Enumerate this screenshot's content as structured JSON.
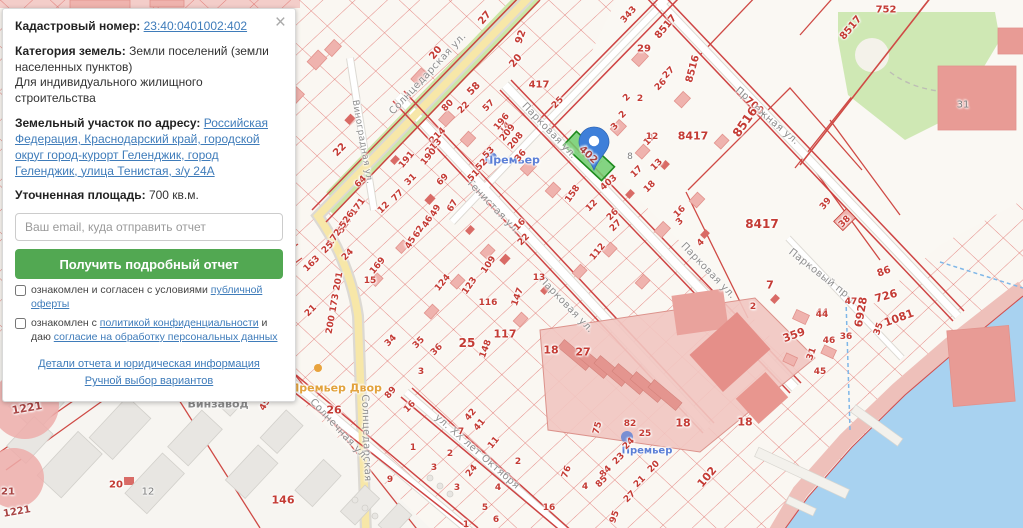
{
  "panel": {
    "close_label": "×",
    "cadastral_label": "Кадастровый номер:",
    "cadastral_number": "23:40:0401002:402",
    "category_label": "Категория земель:",
    "category_value": "Земли поселений (земли населенных пунктов)",
    "category_extra": "Для индивидуального жилищного строительства",
    "address_label": "Земельный участок по адресу:",
    "address_value": "Российская Федерация, Краснодарский край, городской округ город-курорт Геленджик, город Геленджик, улица Тенистая, з/у 24А",
    "area_label": "Уточненная площадь:",
    "area_value": "700 кв.м.",
    "email_placeholder": "Ваш email, куда отправить отчет",
    "submit_label": "Получить подробный отчет",
    "checkbox1_prefix": "ознакомлен и согласен с условиями ",
    "checkbox1_link": "публичной оферты",
    "checkbox2_prefix": "ознакомлен с ",
    "checkbox2_link": "политикой конфиденциальности",
    "checkbox2_middle": " и даю ",
    "checkbox2_link2": "согласие на обработку персональных данных",
    "link_details": "Детали отчета и юридическая информация",
    "link_manual": "Ручной выбор вариантов"
  },
  "map": {
    "highlighted_parcel": "402",
    "colors": {
      "water": "#a8d2f0",
      "park": "#cfe8b4",
      "parcel_lines": "#dd5f5a",
      "highlight_fill": "#6fce6f",
      "marker": "#3e7fd9",
      "road_yellow": "#f7e7a8"
    },
    "labels": [
      [
        "Солнцедарская ул.",
        428,
        74,
        -47,
        "street",
        10
      ],
      [
        "Солнцедарская",
        366,
        438,
        88,
        "street",
        10
      ],
      [
        "Виноградная ул.",
        362,
        142,
        80,
        "street",
        9
      ],
      [
        "Тенистая ул.",
        493,
        207,
        46,
        "street",
        10
      ],
      [
        "Парковая ул.",
        549,
        131,
        46,
        "street",
        10
      ],
      [
        "Парковая ул.",
        566,
        305,
        46,
        "street",
        10
      ],
      [
        "Парковая ул.",
        708,
        271,
        46,
        "street",
        10
      ],
      [
        "Парковый пр-д",
        823,
        277,
        38,
        "street",
        10
      ],
      [
        "Солнечная ул.",
        339,
        430,
        47,
        "street",
        10
      ],
      [
        "ул. ХХ лет Октября",
        477,
        452,
        41,
        "street",
        10
      ],
      [
        "Пр",
        742,
        94,
        40,
        "street",
        10
      ],
      [
        "700",
        754,
        106,
        40,
        "red",
        10
      ],
      [
        "ежная ул.",
        776,
        125,
        40,
        "street",
        10
      ],
      [
        "Премьер",
        512,
        160,
        0,
        "blue",
        11
      ],
      [
        "Премьер",
        647,
        451,
        0,
        "blue",
        10
      ],
      [
        "Премьер Двор",
        336,
        388,
        0,
        "orange",
        11
      ],
      [
        "Винзавод",
        218,
        404,
        0,
        "poigray",
        11
      ],
      [
        "402",
        588,
        155,
        43,
        "darkred",
        10
      ],
      [
        "22",
        340,
        150,
        -45,
        "red",
        10
      ],
      [
        "20",
        436,
        53,
        -50,
        "red",
        10
      ],
      [
        "27",
        485,
        18,
        -50,
        "red",
        10
      ],
      [
        "92",
        521,
        37,
        -70,
        "red",
        10
      ],
      [
        "20",
        516,
        61,
        -50,
        "red",
        10
      ],
      [
        "58",
        474,
        89,
        -45,
        "red",
        10
      ],
      [
        "417",
        539,
        85,
        0,
        "red",
        10
      ],
      [
        "80",
        448,
        106,
        -45,
        "red",
        9
      ],
      [
        "22",
        464,
        108,
        -45,
        "red",
        9
      ],
      [
        "57",
        489,
        106,
        -45,
        "red",
        9
      ],
      [
        "14",
        505,
        128,
        -45,
        "red",
        9
      ],
      [
        "214",
        438,
        136,
        -45,
        "red",
        9
      ],
      [
        "213",
        434,
        147,
        -45,
        "red",
        9
      ],
      [
        "196",
        502,
        122,
        -50,
        "red",
        9
      ],
      [
        "209",
        508,
        133,
        -50,
        "red",
        9
      ],
      [
        "208",
        516,
        141,
        -50,
        "red",
        9
      ],
      [
        "191",
        407,
        160,
        -50,
        "red",
        9
      ],
      [
        "190",
        429,
        157,
        -50,
        "red",
        9
      ],
      [
        "31",
        411,
        180,
        -45,
        "red",
        9
      ],
      [
        "77",
        398,
        196,
        -45,
        "red",
        9
      ],
      [
        "12",
        384,
        208,
        -45,
        "red",
        9
      ],
      [
        "69",
        443,
        180,
        -45,
        "red",
        9
      ],
      [
        "53",
        489,
        153,
        -45,
        "red",
        9
      ],
      [
        "52",
        482,
        165,
        -45,
        "red",
        9
      ],
      [
        "51",
        474,
        176,
        -45,
        "red",
        9
      ],
      [
        "64",
        361,
        182,
        -45,
        "red",
        9
      ],
      [
        "527 171",
        352,
        216,
        -55,
        "red",
        9
      ],
      [
        "172 526",
        341,
        229,
        -55,
        "red",
        9
      ],
      [
        "49",
        436,
        211,
        -60,
        "red",
        9
      ],
      [
        "46",
        428,
        222,
        -60,
        "red",
        9
      ],
      [
        "62",
        419,
        232,
        -60,
        "red",
        9
      ],
      [
        "45",
        411,
        243,
        -60,
        "red",
        9
      ],
      [
        "67",
        453,
        206,
        -60,
        "red",
        9
      ],
      [
        "25",
        328,
        248,
        -45,
        "red",
        9
      ],
      [
        "24",
        348,
        255,
        -45,
        "red",
        9
      ],
      [
        "163",
        312,
        264,
        -45,
        "red",
        9
      ],
      [
        "169",
        378,
        266,
        -50,
        "red",
        9
      ],
      [
        "15",
        370,
        281,
        0,
        "red",
        9
      ],
      [
        "200 173 201",
        335,
        303,
        -80,
        "red",
        9
      ],
      [
        "21",
        311,
        311,
        -45,
        "red",
        9
      ],
      [
        "36",
        521,
        156,
        -50,
        "red",
        9
      ],
      [
        "16",
        520,
        225,
        -45,
        "red",
        9
      ],
      [
        "22",
        524,
        240,
        -45,
        "red",
        9
      ],
      [
        "25",
        558,
        103,
        -45,
        "red",
        9
      ],
      [
        "2",
        627,
        98,
        -45,
        "red",
        9
      ],
      [
        "2",
        623,
        115,
        -45,
        "red",
        9
      ],
      [
        "3",
        615,
        127,
        -45,
        "red",
        9
      ],
      [
        "12",
        650,
        140,
        -45,
        "red",
        9
      ],
      [
        "13",
        657,
        165,
        -45,
        "red",
        9
      ],
      [
        "17",
        637,
        172,
        -45,
        "red",
        9
      ],
      [
        "18",
        650,
        187,
        -45,
        "red",
        9
      ],
      [
        "8",
        630,
        157,
        0,
        "gray",
        9
      ],
      [
        "403",
        609,
        183,
        -40,
        "red",
        9
      ],
      [
        "158",
        573,
        194,
        -55,
        "red",
        9
      ],
      [
        "12",
        592,
        206,
        -45,
        "red",
        9
      ],
      [
        "26",
        613,
        215,
        -45,
        "red",
        9
      ],
      [
        "27",
        616,
        226,
        -45,
        "red",
        9
      ],
      [
        "112",
        598,
        252,
        -50,
        "red",
        9
      ],
      [
        "16",
        680,
        212,
        -45,
        "red",
        9
      ],
      [
        "3",
        680,
        222,
        -45,
        "red",
        9
      ],
      [
        "4",
        701,
        243,
        -45,
        "red",
        9
      ],
      [
        "109",
        489,
        265,
        -55,
        "red",
        9
      ],
      [
        "124",
        443,
        283,
        -50,
        "red",
        9
      ],
      [
        "123",
        470,
        286,
        -55,
        "red",
        9
      ],
      [
        "116",
        488,
        303,
        0,
        "red",
        9
      ],
      [
        "147",
        518,
        297,
        -70,
        "red",
        9
      ],
      [
        "13",
        539,
        278,
        0,
        "red",
        9
      ],
      [
        "8417",
        693,
        136,
        0,
        "red",
        11
      ],
      [
        "8417",
        762,
        224,
        0,
        "red",
        12
      ],
      [
        "8517",
        666,
        27,
        -50,
        "red",
        10
      ],
      [
        "8516",
        693,
        69,
        -75,
        "red",
        10
      ],
      [
        "8516",
        745,
        122,
        -55,
        "red",
        12
      ],
      [
        "8517",
        851,
        28,
        -50,
        "red",
        10
      ],
      [
        "343",
        629,
        15,
        -48,
        "red",
        9
      ],
      [
        "29",
        644,
        49,
        0,
        "red",
        10
      ],
      [
        "27",
        669,
        73,
        -45,
        "red",
        9
      ],
      [
        "26",
        661,
        85,
        -45,
        "red",
        9
      ],
      [
        "2",
        640,
        99,
        0,
        "red",
        9
      ],
      [
        "12",
        652,
        137,
        0,
        "red",
        9
      ],
      [
        "39",
        826,
        204,
        -50,
        "red",
        9
      ],
      [
        "38",
        845,
        222,
        -45,
        "red",
        9
      ],
      [
        "44",
        822,
        313,
        0,
        "red",
        9
      ],
      [
        "7",
        770,
        285,
        0,
        "red",
        11
      ],
      [
        "2",
        753,
        307,
        0,
        "red",
        9
      ],
      [
        "752",
        886,
        10,
        0,
        "red",
        10
      ],
      [
        "31",
        963,
        105,
        0,
        "gray",
        10
      ],
      [
        "86",
        884,
        272,
        -20,
        "red",
        10
      ],
      [
        "726",
        886,
        296,
        -15,
        "red",
        11
      ],
      [
        "6928",
        861,
        312,
        -80,
        "red",
        11
      ],
      [
        "1081",
        899,
        318,
        -20,
        "red",
        11
      ],
      [
        "47",
        851,
        302,
        0,
        "red",
        9
      ],
      [
        "44",
        822,
        315,
        0,
        "red",
        9
      ],
      [
        "359",
        794,
        335,
        -20,
        "red",
        11
      ],
      [
        "46",
        829,
        341,
        0,
        "red",
        9
      ],
      [
        "36",
        846,
        337,
        0,
        "red",
        9
      ],
      [
        "35",
        879,
        329,
        -70,
        "red",
        9
      ],
      [
        "31",
        812,
        354,
        -70,
        "red",
        9
      ],
      [
        "45",
        820,
        372,
        0,
        "red",
        9
      ],
      [
        "34",
        391,
        341,
        -45,
        "red",
        9
      ],
      [
        "35",
        419,
        343,
        -45,
        "red",
        9
      ],
      [
        "36",
        437,
        350,
        -45,
        "red",
        9
      ],
      [
        "25",
        467,
        343,
        0,
        "red",
        12
      ],
      [
        "117",
        505,
        334,
        0,
        "red",
        11
      ],
      [
        "148",
        486,
        349,
        -70,
        "red",
        9
      ],
      [
        "89",
        391,
        393,
        -50,
        "red",
        9
      ],
      [
        "16",
        410,
        407,
        -45,
        "red",
        9
      ],
      [
        "3",
        421,
        372,
        0,
        "red",
        9
      ],
      [
        "42",
        471,
        415,
        -50,
        "red",
        9
      ],
      [
        "41",
        480,
        425,
        -50,
        "red",
        9
      ],
      [
        "7",
        461,
        432,
        0,
        "red",
        9
      ],
      [
        "11",
        494,
        443,
        -50,
        "red",
        9
      ],
      [
        "2",
        450,
        454,
        0,
        "red",
        9
      ],
      [
        "24",
        472,
        471,
        -50,
        "red",
        9
      ],
      [
        "3",
        434,
        468,
        0,
        "red",
        9
      ],
      [
        "3",
        457,
        488,
        0,
        "red",
        9
      ],
      [
        "4",
        498,
        488,
        0,
        "red",
        9
      ],
      [
        "2",
        518,
        462,
        0,
        "red",
        9
      ],
      [
        "5",
        485,
        508,
        0,
        "red",
        9
      ],
      [
        "6",
        496,
        520,
        0,
        "red",
        9
      ],
      [
        "1",
        466,
        525,
        0,
        "red",
        9
      ],
      [
        "9",
        390,
        480,
        0,
        "red",
        9
      ],
      [
        "1",
        413,
        448,
        0,
        "red",
        9
      ],
      [
        "18",
        551,
        350,
        0,
        "red",
        11
      ],
      [
        "27",
        583,
        352,
        0,
        "red",
        11
      ],
      [
        "76",
        567,
        472,
        -70,
        "red",
        9
      ],
      [
        "75",
        598,
        428,
        -75,
        "red",
        9
      ],
      [
        "82",
        630,
        424,
        0,
        "red",
        9
      ],
      [
        "25",
        645,
        434,
        0,
        "red",
        9
      ],
      [
        "24",
        629,
        444,
        -45,
        "red",
        9
      ],
      [
        "23",
        619,
        459,
        -45,
        "red",
        9
      ],
      [
        "84",
        606,
        472,
        -45,
        "red",
        9
      ],
      [
        "85",
        602,
        482,
        -45,
        "red",
        9
      ],
      [
        "20",
        654,
        467,
        -45,
        "red",
        9
      ],
      [
        "21",
        640,
        482,
        -45,
        "red",
        9
      ],
      [
        "27",
        630,
        497,
        -45,
        "red",
        9
      ],
      [
        "95",
        615,
        517,
        -70,
        "red",
        9
      ],
      [
        "4",
        585,
        487,
        0,
        "red",
        9
      ],
      [
        "16",
        549,
        508,
        0,
        "red",
        9
      ],
      [
        "102",
        707,
        477,
        -50,
        "red",
        11
      ],
      [
        "18",
        683,
        423,
        0,
        "red",
        11
      ],
      [
        "18",
        745,
        422,
        0,
        "red",
        11
      ],
      [
        "460",
        258,
        362,
        0,
        "red",
        11
      ],
      [
        "459",
        267,
        402,
        -60,
        "red",
        9
      ],
      [
        "26",
        334,
        410,
        0,
        "red",
        11
      ],
      [
        "146",
        283,
        500,
        0,
        "red",
        11
      ],
      [
        "20",
        116,
        485,
        0,
        "red",
        10
      ],
      [
        "12",
        148,
        492,
        0,
        "gray",
        10
      ],
      [
        "1221",
        27,
        408,
        -10,
        "darkred",
        11
      ],
      [
        "21",
        8,
        492,
        0,
        "darkred",
        10
      ],
      [
        "1221",
        17,
        512,
        -10,
        "darkred",
        10
      ]
    ]
  }
}
